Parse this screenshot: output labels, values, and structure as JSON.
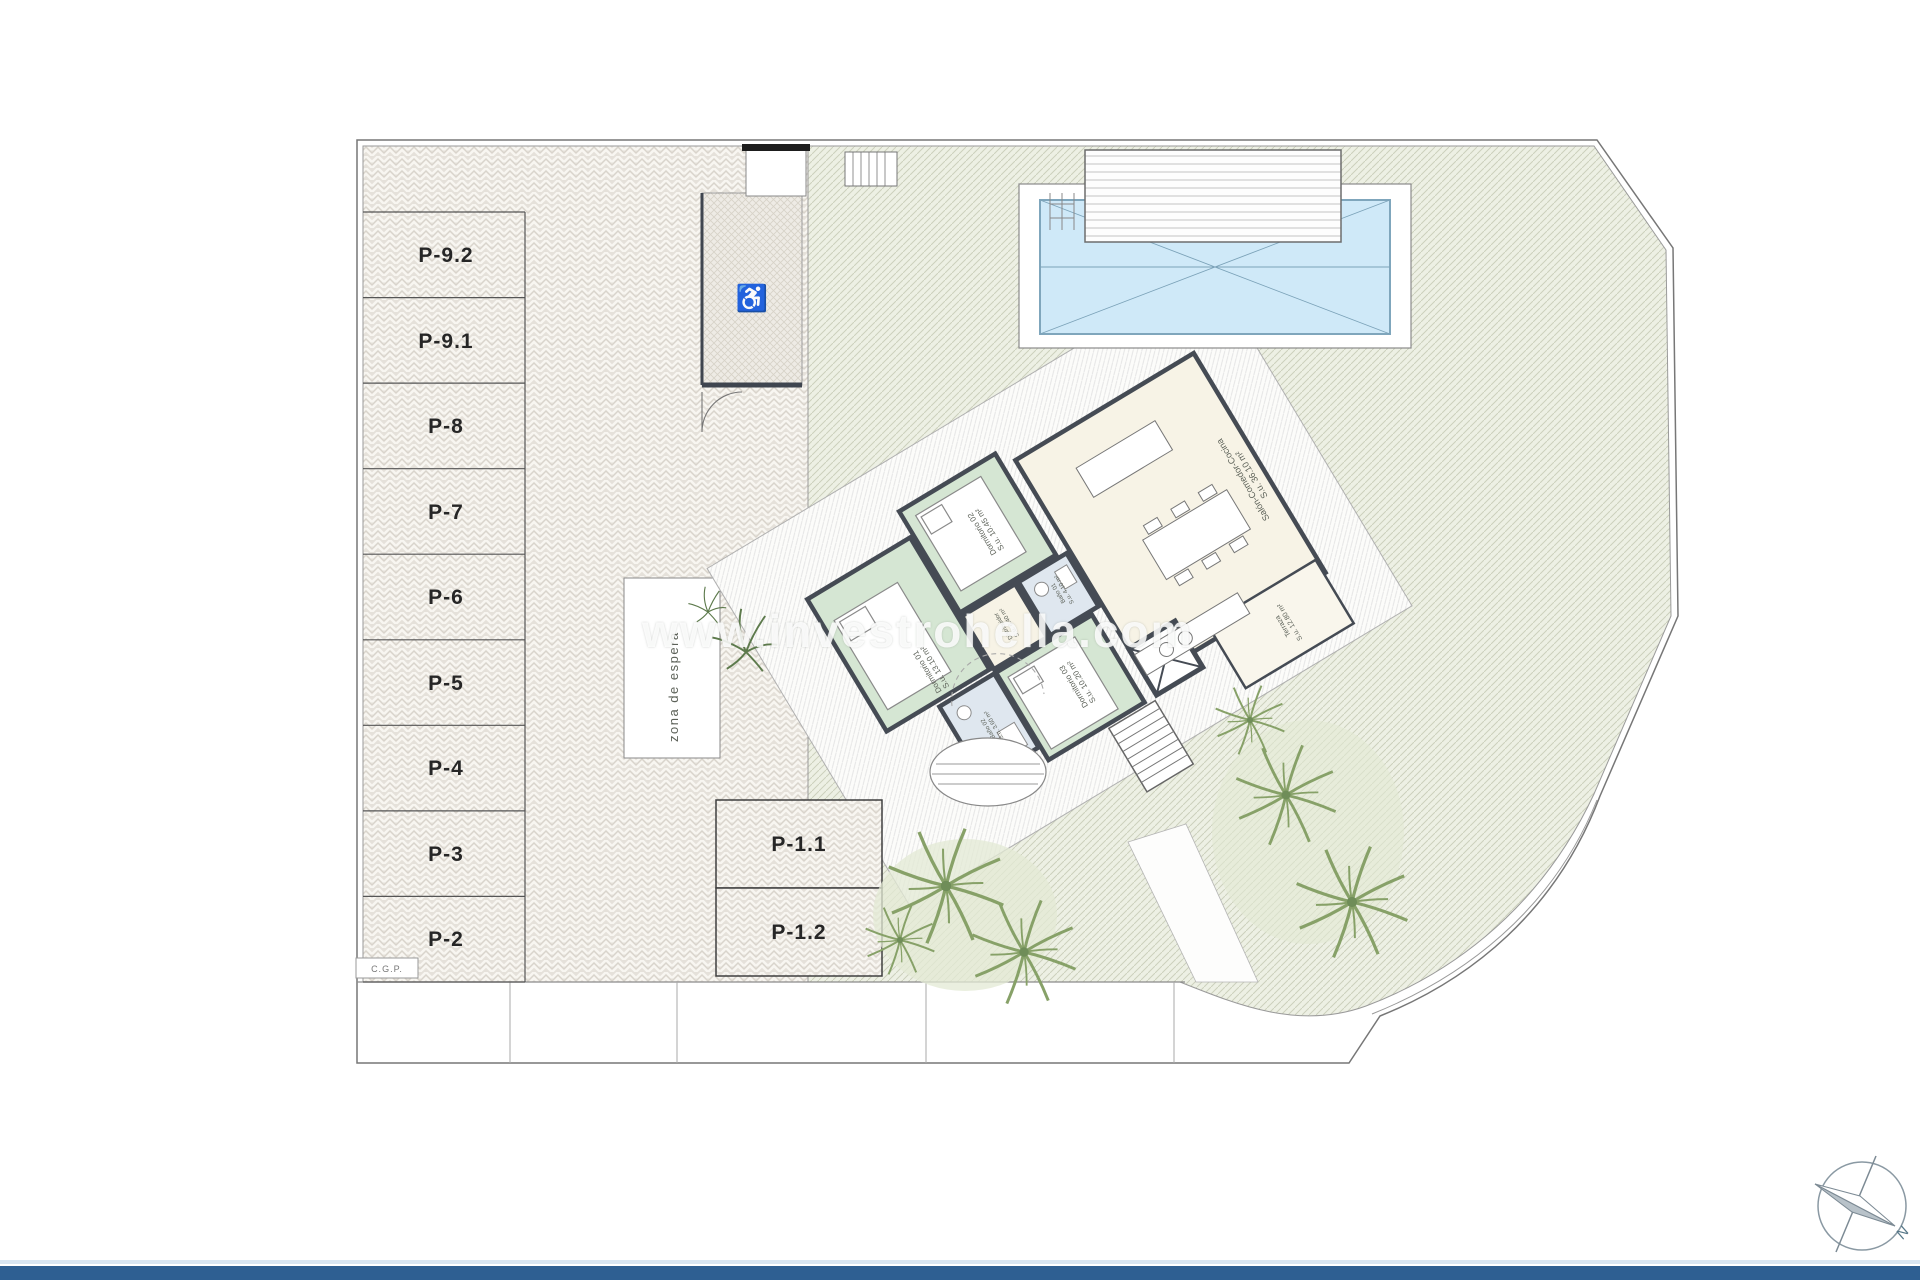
{
  "watermark": {
    "text": "www.investrohella.com"
  },
  "parking": {
    "stalls": [
      "P-9.2",
      "P-9.1",
      "P-8",
      "P-7",
      "P-6",
      "P-5",
      "P-4",
      "P-3",
      "P-2"
    ],
    "lower_stalls": [
      "P-1.1",
      "P-1.2"
    ],
    "waiting_area_label": "zona de espera",
    "cgp_label": "C.G.P."
  },
  "rooms": [
    {
      "name": "Dormitorio 01",
      "area": "S.u. 13.10 m²"
    },
    {
      "name": "Dormitorio 02",
      "area": "S.u. 10.45 m²"
    },
    {
      "name": "Dormitorio 03",
      "area": "S.u. 10.20 m²"
    },
    {
      "name": "Baño 01",
      "area": "S.u. 4.10 m²"
    },
    {
      "name": "Baño 02",
      "area": "S.u. 3.60 m²"
    },
    {
      "name": "Distribuidor",
      "area": "S.u. 6.40 m²"
    },
    {
      "name": "Salón-Comedor-Cocina",
      "area": "S.u. 36.10 m²"
    },
    {
      "name": "Terraza",
      "area": "S.u. 12.80 m²"
    }
  ],
  "compass": {
    "north_label": "N"
  },
  "symbols": {
    "accessible_parking": "♿"
  },
  "colors": {
    "wall": "#454b54",
    "bedroom": "#d5e6d3",
    "bath": "#dfe7ef",
    "living": "#f7f3e6",
    "pool_water": "#cfe9f8",
    "garden": "#edf0e4",
    "paving": "#e5e1da",
    "footer_bar": "#2e5f92"
  }
}
